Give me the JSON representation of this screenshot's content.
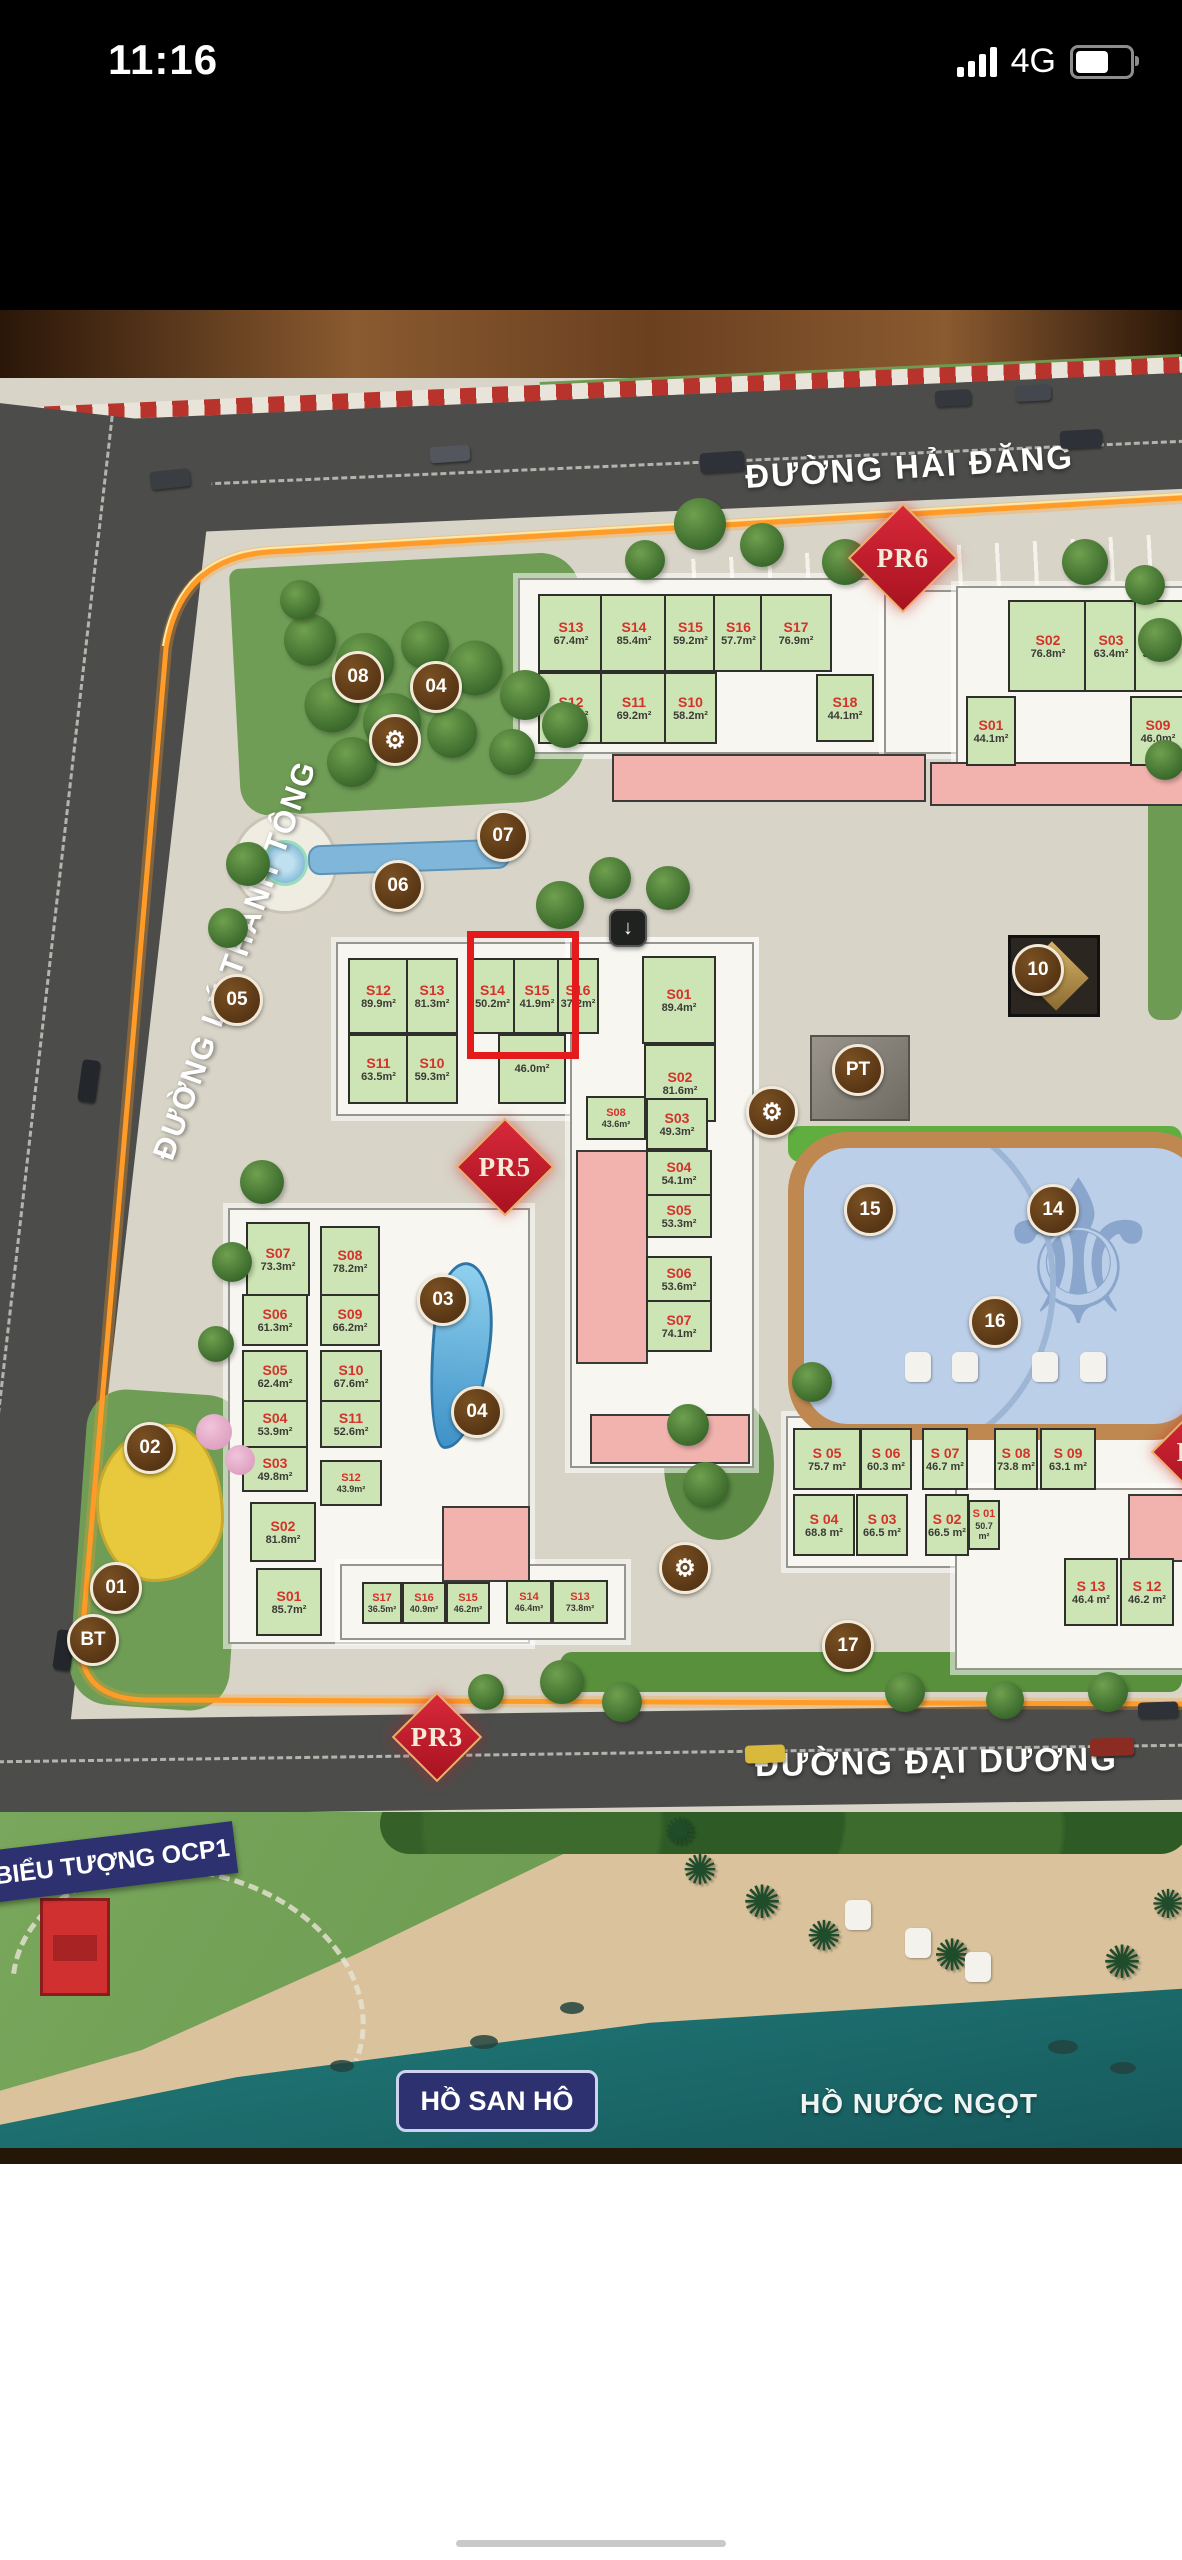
{
  "status_bar": {
    "time": "11:16",
    "network": "4G"
  },
  "map": {
    "streets": [
      {
        "name": "ĐƯỜNG HẢI ĐĂNG"
      },
      {
        "name": "ĐƯỜNG LÝ THÁNH TÔNG"
      },
      {
        "name": "ĐƯỜNG ĐẠI DƯƠNG"
      }
    ],
    "lakes": [
      {
        "name": "HỒ SAN HÔ"
      },
      {
        "name": "HỒ NƯỚC NGỌT"
      }
    ],
    "landmark": "BIỂU TƯỢNG OCP1",
    "highlight": {
      "x": 467,
      "y": 931,
      "w": 98,
      "h": 114
    },
    "pr_markers": [
      {
        "label": "PR6",
        "x": 903,
        "y": 558,
        "s": 74
      },
      {
        "label": "PR5",
        "x": 505,
        "y": 1167,
        "s": 66
      },
      {
        "label": "PR3",
        "x": 437,
        "y": 1737,
        "s": 60
      },
      {
        "label": "PR",
        "x": 1196,
        "y": 1452,
        "s": 60
      }
    ],
    "circles": [
      {
        "label": "08",
        "x": 358,
        "y": 677
      },
      {
        "label": "04",
        "x": 436,
        "y": 687
      },
      {
        "label": "07",
        "x": 503,
        "y": 836
      },
      {
        "label": "06",
        "x": 398,
        "y": 886
      },
      {
        "label": "05",
        "x": 237,
        "y": 1000
      },
      {
        "label": "03",
        "x": 443,
        "y": 1300
      },
      {
        "label": "04",
        "x": 477,
        "y": 1412
      },
      {
        "label": "02",
        "x": 150,
        "y": 1448
      },
      {
        "label": "01",
        "x": 116,
        "y": 1588
      },
      {
        "label": "BT",
        "x": 93,
        "y": 1640
      },
      {
        "label": "10",
        "x": 1038,
        "y": 970
      },
      {
        "label": "PT",
        "x": 858,
        "y": 1070
      },
      {
        "label": "15",
        "x": 870,
        "y": 1210
      },
      {
        "label": "14",
        "x": 1053,
        "y": 1210
      },
      {
        "label": "16",
        "x": 995,
        "y": 1322
      },
      {
        "label": "17",
        "x": 848,
        "y": 1646
      },
      {
        "type": "gear",
        "label": "⚙",
        "x": 395,
        "y": 740
      },
      {
        "type": "gear",
        "label": "⚙",
        "x": 772,
        "y": 1112
      },
      {
        "type": "gear",
        "label": "⚙",
        "x": 685,
        "y": 1568
      },
      {
        "type": "arrow",
        "label": "↓",
        "x": 628,
        "y": 928
      }
    ],
    "buildings": [
      {
        "id": "top",
        "slabs": [
          {
            "x": 518,
            "y": 578,
            "w": 366,
            "h": 172
          },
          {
            "x": 884,
            "y": 590,
            "w": 76,
            "h": 160
          },
          {
            "x": 956,
            "y": 586,
            "w": 226,
            "h": 190
          }
        ],
        "pink": [
          {
            "x": 612,
            "y": 754,
            "w": 310,
            "h": 44
          },
          {
            "x": 930,
            "y": 762,
            "w": 252,
            "h": 40
          }
        ],
        "units": [
          {
            "label": "S13",
            "area": "67.4m²",
            "x": 538,
            "y": 594,
            "w": 62,
            "h": 74
          },
          {
            "label": "S14",
            "area": "85.4m²",
            "x": 600,
            "y": 594,
            "w": 64,
            "h": 74
          },
          {
            "label": "S15",
            "area": "59.2m²",
            "x": 664,
            "y": 594,
            "w": 49,
            "h": 74
          },
          {
            "label": "S16",
            "area": "57.7m²",
            "x": 713,
            "y": 594,
            "w": 47,
            "h": 74
          },
          {
            "label": "S17",
            "area": "76.9m²",
            "x": 760,
            "y": 594,
            "w": 68,
            "h": 74
          },
          {
            "label": "S12",
            "area": "73.6m²",
            "x": 538,
            "y": 672,
            "w": 62,
            "h": 68
          },
          {
            "label": "S11",
            "area": "69.2m²",
            "x": 600,
            "y": 672,
            "w": 64,
            "h": 68
          },
          {
            "label": "S10",
            "area": "58.2m²",
            "x": 664,
            "y": 672,
            "w": 49,
            "h": 68
          },
          {
            "label": "S18",
            "area": "44.1m²",
            "x": 816,
            "y": 674,
            "w": 54,
            "h": 64
          },
          {
            "label": "S02",
            "area": "76.8m²",
            "x": 1008,
            "y": 600,
            "w": 76,
            "h": 88
          },
          {
            "label": "S03",
            "area": "63.4m²",
            "x": 1084,
            "y": 600,
            "w": 50,
            "h": 88
          },
          {
            "label": "S04",
            "area": "59.4m²",
            "x": 1134,
            "y": 600,
            "w": 48,
            "h": 88
          },
          {
            "label": "S01",
            "area": "44.1m²",
            "x": 966,
            "y": 696,
            "w": 46,
            "h": 66
          },
          {
            "label": "S09",
            "area": "46.0m²",
            "x": 1130,
            "y": 696,
            "w": 52,
            "h": 66
          }
        ]
      },
      {
        "id": "middle",
        "slabs": [
          {
            "x": 336,
            "y": 942,
            "w": 414,
            "h": 170
          },
          {
            "x": 570,
            "y": 942,
            "w": 180,
            "h": 522
          }
        ],
        "pink": [
          {
            "x": 576,
            "y": 1150,
            "w": 68,
            "h": 210
          },
          {
            "x": 590,
            "y": 1414,
            "w": 156,
            "h": 46
          }
        ],
        "units": [
          {
            "label": "S12",
            "area": "89.9m²",
            "x": 348,
            "y": 958,
            "w": 57,
            "h": 72
          },
          {
            "label": "S13",
            "area": "81.3m²",
            "x": 406,
            "y": 958,
            "w": 48,
            "h": 72
          },
          {
            "label": "S14",
            "area": "50.2m²",
            "x": 468,
            "y": 958,
            "w": 45,
            "h": 72
          },
          {
            "label": "S15",
            "area": "41.9m²",
            "x": 513,
            "y": 958,
            "w": 44,
            "h": 72
          },
          {
            "label": "S16",
            "area": "37.2m²",
            "x": 557,
            "y": 958,
            "w": 38,
            "h": 72
          },
          {
            "label": "S01",
            "area": "89.4m²",
            "x": 642,
            "y": 956,
            "w": 70,
            "h": 84
          },
          {
            "label": "S11",
            "area": "63.5m²",
            "x": 348,
            "y": 1034,
            "w": 57,
            "h": 66
          },
          {
            "label": "S10",
            "area": "59.3m²",
            "x": 406,
            "y": 1034,
            "w": 48,
            "h": 66
          },
          {
            "label": "",
            "area": "46.0m²",
            "x": 498,
            "y": 1034,
            "w": 64,
            "h": 66
          },
          {
            "label": "S02",
            "area": "81.6m²",
            "x": 644,
            "y": 1044,
            "w": 68,
            "h": 74
          },
          {
            "label": "S08",
            "area": "43.6m²",
            "x": 586,
            "y": 1096,
            "w": 56,
            "h": 40,
            "small": true
          },
          {
            "label": "S03",
            "area": "49.3m²",
            "x": 646,
            "y": 1098,
            "w": 58,
            "h": 48
          },
          {
            "label": "S04",
            "area": "54.1m²",
            "x": 646,
            "y": 1150,
            "w": 62,
            "h": 42
          },
          {
            "label": "S05",
            "area": "53.3m²",
            "x": 646,
            "y": 1194,
            "w": 62,
            "h": 40
          },
          {
            "label": "S06",
            "area": "53.6m²",
            "x": 646,
            "y": 1256,
            "w": 62,
            "h": 42
          },
          {
            "label": "S07",
            "area": "74.1m²",
            "x": 646,
            "y": 1300,
            "w": 62,
            "h": 48
          }
        ]
      },
      {
        "id": "bottom-left",
        "slabs": [
          {
            "x": 228,
            "y": 1208,
            "w": 298,
            "h": 432
          },
          {
            "x": 340,
            "y": 1564,
            "w": 282,
            "h": 72
          }
        ],
        "pink": [
          {
            "x": 442,
            "y": 1506,
            "w": 84,
            "h": 72
          }
        ],
        "units": [
          {
            "label": "S07",
            "area": "73.3m²",
            "x": 246,
            "y": 1222,
            "w": 60,
            "h": 70
          },
          {
            "label": "S08",
            "area": "78.2m²",
            "x": 320,
            "y": 1226,
            "w": 56,
            "h": 66
          },
          {
            "label": "S06",
            "area": "61.3m²",
            "x": 242,
            "y": 1294,
            "w": 62,
            "h": 48
          },
          {
            "label": "S09",
            "area": "66.2m²",
            "x": 320,
            "y": 1294,
            "w": 56,
            "h": 48
          },
          {
            "label": "S05",
            "area": "62.4m²",
            "x": 242,
            "y": 1350,
            "w": 62,
            "h": 48
          },
          {
            "label": "S10",
            "area": "67.6m²",
            "x": 320,
            "y": 1350,
            "w": 58,
            "h": 48
          },
          {
            "label": "S04",
            "area": "53.9m²",
            "x": 242,
            "y": 1400,
            "w": 62,
            "h": 44
          },
          {
            "label": "S11",
            "area": "52.6m²",
            "x": 320,
            "y": 1400,
            "w": 58,
            "h": 44
          },
          {
            "label": "S03",
            "area": "49.8m²",
            "x": 242,
            "y": 1446,
            "w": 62,
            "h": 42
          },
          {
            "label": "S12",
            "area": "43.9m²",
            "x": 320,
            "y": 1460,
            "w": 58,
            "h": 42,
            "small": true
          },
          {
            "label": "S02",
            "area": "81.8m²",
            "x": 250,
            "y": 1502,
            "w": 62,
            "h": 56
          },
          {
            "label": "S01",
            "area": "85.7m²",
            "x": 256,
            "y": 1568,
            "w": 62,
            "h": 64
          },
          {
            "label": "S17",
            "area": "36.5m²",
            "x": 362,
            "y": 1582,
            "w": 36,
            "h": 38,
            "small": true
          },
          {
            "label": "S16",
            "area": "40.9m²",
            "x": 402,
            "y": 1582,
            "w": 40,
            "h": 38,
            "small": true
          },
          {
            "label": "S15",
            "area": "46.2m²",
            "x": 446,
            "y": 1582,
            "w": 40,
            "h": 38,
            "small": true
          },
          {
            "label": "S14",
            "area": "46.4m²",
            "x": 506,
            "y": 1580,
            "w": 42,
            "h": 40,
            "small": true
          },
          {
            "label": "S13",
            "area": "73.8m²",
            "x": 552,
            "y": 1580,
            "w": 52,
            "h": 40,
            "small": true
          }
        ]
      },
      {
        "id": "bottom-right",
        "slabs": [
          {
            "x": 786,
            "y": 1416,
            "w": 396,
            "h": 148
          },
          {
            "x": 955,
            "y": 1488,
            "w": 227,
            "h": 178
          }
        ],
        "pink": [
          {
            "x": 1128,
            "y": 1494,
            "w": 54,
            "h": 64
          }
        ],
        "units": [
          {
            "label": "S 05",
            "area": "75.7 m²",
            "x": 793,
            "y": 1428,
            "w": 64,
            "h": 58
          },
          {
            "label": "S 06",
            "area": "60.3 m²",
            "x": 860,
            "y": 1428,
            "w": 48,
            "h": 58
          },
          {
            "label": "S 07",
            "area": "46.7 m²",
            "x": 922,
            "y": 1428,
            "w": 42,
            "h": 58
          },
          {
            "label": "S 08",
            "area": "73.8 m²",
            "x": 994,
            "y": 1428,
            "w": 40,
            "h": 58
          },
          {
            "label": "S 09",
            "area": "63.1 m²",
            "x": 1040,
            "y": 1428,
            "w": 52,
            "h": 58
          },
          {
            "label": "S 04",
            "area": "68.8 m²",
            "x": 793,
            "y": 1494,
            "w": 58,
            "h": 58
          },
          {
            "label": "S 03",
            "area": "66.5 m²",
            "x": 856,
            "y": 1494,
            "w": 48,
            "h": 58
          },
          {
            "label": "S 02",
            "area": "66.5 m²",
            "x": 925,
            "y": 1494,
            "w": 40,
            "h": 58
          },
          {
            "label": "S 01",
            "area": "50.7 m²",
            "x": 968,
            "y": 1500,
            "w": 28,
            "h": 46,
            "small": true
          },
          {
            "label": "S 13",
            "area": "46.4 m²",
            "x": 1064,
            "y": 1558,
            "w": 50,
            "h": 64
          },
          {
            "label": "S 12",
            "area": "46.2 m²",
            "x": 1120,
            "y": 1558,
            "w": 50,
            "h": 64
          }
        ]
      }
    ],
    "decor": {
      "trees": [
        [
          310,
          640,
          52
        ],
        [
          365,
          662,
          58
        ],
        [
          425,
          645,
          48
        ],
        [
          475,
          668,
          55
        ],
        [
          525,
          695,
          50
        ],
        [
          565,
          725,
          46
        ],
        [
          332,
          705,
          55
        ],
        [
          392,
          722,
          58
        ],
        [
          452,
          733,
          50
        ],
        [
          512,
          752,
          46
        ],
        [
          352,
          762,
          50
        ],
        [
          300,
          600,
          40
        ],
        [
          560,
          905,
          48
        ],
        [
          610,
          878,
          42
        ],
        [
          668,
          888,
          44
        ],
        [
          248,
          864,
          44
        ],
        [
          228,
          928,
          40
        ],
        [
          262,
          1182,
          44
        ],
        [
          232,
          1262,
          40
        ],
        [
          216,
          1344,
          36
        ],
        [
          562,
          1682,
          44
        ],
        [
          622,
          1702,
          40
        ],
        [
          486,
          1692,
          36
        ],
        [
          688,
          1425,
          42
        ],
        [
          706,
          1485,
          46
        ],
        [
          905,
          1692,
          40
        ],
        [
          1005,
          1700,
          38
        ],
        [
          1108,
          1692,
          40
        ],
        [
          700,
          524,
          52
        ],
        [
          762,
          545,
          44
        ],
        [
          845,
          562,
          46
        ],
        [
          1085,
          562,
          46
        ],
        [
          1145,
          585,
          40
        ],
        [
          812,
          1382,
          40
        ],
        [
          645,
          560,
          40
        ],
        [
          1160,
          640,
          44
        ],
        [
          1165,
          760,
          40
        ]
      ],
      "cars": [
        [
          700,
          452,
          44,
          20,
          "#2e3138",
          -4
        ],
        [
          150,
          470,
          40,
          18,
          "#3a3d42",
          -6
        ],
        [
          430,
          446,
          40,
          16,
          "#53565c",
          -4
        ],
        [
          1060,
          430,
          42,
          18,
          "#2e3138",
          -3
        ],
        [
          935,
          390,
          36,
          16,
          "#34373d",
          -3
        ],
        [
          1015,
          385,
          36,
          16,
          "#44474d",
          -3
        ],
        [
          80,
          1060,
          18,
          42,
          "#23262b",
          8
        ],
        [
          55,
          1630,
          18,
          40,
          "#23262b",
          8
        ],
        [
          745,
          1745,
          40,
          18,
          "#d8b93c",
          -2
        ],
        [
          1090,
          1738,
          44,
          18,
          "#8a2c22",
          -2
        ],
        [
          1138,
          1702,
          40,
          16,
          "#2e3138",
          -2
        ]
      ],
      "lounges": [
        [
          905,
          1352
        ],
        [
          952,
          1352
        ],
        [
          1032,
          1352
        ],
        [
          1080,
          1352
        ],
        [
          845,
          1900
        ],
        [
          905,
          1928
        ],
        [
          965,
          1952
        ]
      ],
      "palms": [
        [
          700,
          1870,
          42
        ],
        [
          762,
          1902,
          46
        ],
        [
          824,
          1936,
          42
        ],
        [
          952,
          1956,
          44
        ],
        [
          1122,
          1962,
          46
        ],
        [
          680,
          1832,
          38
        ],
        [
          1168,
          1905,
          40
        ]
      ],
      "rocks": [
        [
          470,
          2035,
          28,
          14
        ],
        [
          560,
          2002,
          24,
          12
        ],
        [
          1048,
          2040,
          30,
          14
        ],
        [
          1110,
          2062,
          26,
          12
        ],
        [
          330,
          2060,
          24,
          12
        ]
      ]
    }
  }
}
